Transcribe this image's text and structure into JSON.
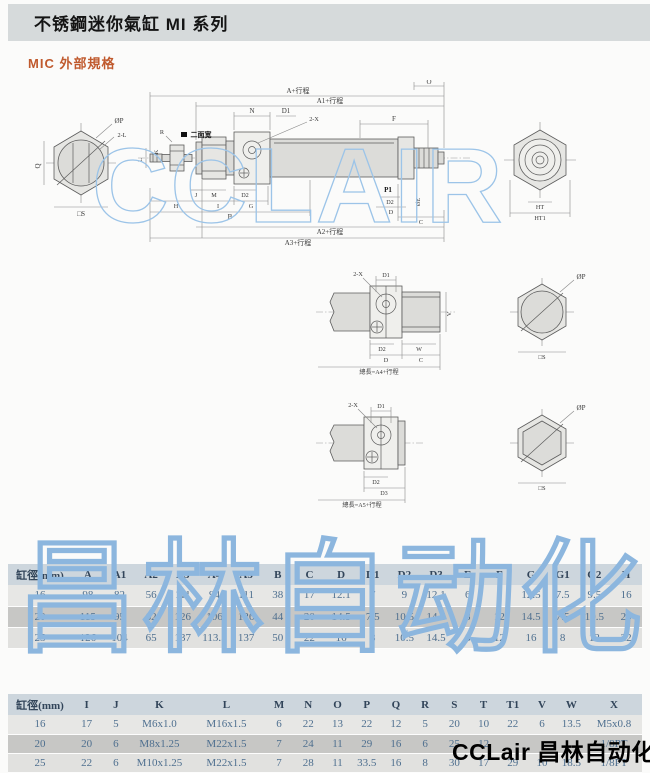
{
  "header": {
    "title": "不锈鋼迷你氣缸 MI 系列"
  },
  "section": {
    "title": "MIC 外部規格"
  },
  "watermarks": {
    "drawing": "CCLAIR",
    "table": "昌林自动化"
  },
  "logo": {
    "text": "CCLair 昌林自动化"
  },
  "colors": {
    "accent_orange": "#c05a2e",
    "watermark_blue": "#8cb6de",
    "table_header_bg": "#cdd6dd",
    "row_dark_bg": "#c7c7c5"
  },
  "dwg": {
    "main": {
      "a_stroke": "A+行程",
      "a1_stroke": "A1+行程",
      "a2_stroke": "A2+行程",
      "a3_stroke": "A3+行程",
      "o": "O",
      "n": "N",
      "d1": "D1",
      "two_x": "2-X",
      "f": "F",
      "r": "R",
      "flats": "二面宽",
      "l": "L",
      "k": "K",
      "j": "J",
      "m": "M",
      "d2": "D2",
      "h": "H",
      "i": "I",
      "g": "G",
      "b": "B",
      "p1": "P1",
      "d2b": "D2",
      "d": "D",
      "oe": "ØE",
      "c": "C",
      "ht": "HT",
      "ht1": "HT1",
      "op": "ØP",
      "two_l": "2-L",
      "q": "Q",
      "s": "□S"
    },
    "view2": {
      "two_x": "2-X",
      "d1": "D1",
      "d2": "D2",
      "w": "W",
      "d": "D",
      "c": "C",
      "v": "V",
      "total": "總長=A4+行程",
      "op": "ØP",
      "s": "□S"
    },
    "view3": {
      "two_x": "2-X",
      "d1": "D1",
      "d2": "D2",
      "d3": "D3",
      "total": "總長=A5+行程",
      "op": "ØP",
      "s": "□S"
    }
  },
  "tables": {
    "dimensions1": {
      "headers": [
        "缸徑(mm)",
        "A",
        "A1",
        "A2",
        "A3",
        "A4",
        "A5",
        "B",
        "C",
        "D",
        "D1",
        "D2",
        "D3",
        "E",
        "F",
        "G",
        "G1",
        "G2",
        "H"
      ],
      "rows": [
        [
          "16",
          "98",
          "82",
          "56",
          "111",
          "94",
          "111",
          "38",
          "17",
          "12.1",
          "7",
          "9",
          "12.1",
          "6",
          "9",
          "12.5",
          "7.5",
          "9.5",
          "16"
        ],
        [
          "20",
          "115",
          "95",
          "62",
          "126",
          "106",
          "126",
          "44",
          "20",
          "14.5",
          "7.5",
          "10.5",
          "14.5",
          "8",
          "12",
          "14.5",
          "7.5",
          "10.5",
          "20"
        ],
        [
          "25",
          "126",
          "104",
          "65",
          "137",
          "113.5",
          "137",
          "50",
          "22",
          "16",
          "8",
          "10.5",
          "14.5",
          "8",
          "12",
          "16",
          "8",
          "12",
          "22"
        ]
      ]
    },
    "dimensions2": {
      "headers": [
        "缸徑(mm)",
        "I",
        "J",
        "K",
        "L",
        "M",
        "N",
        "O",
        "P",
        "Q",
        "R",
        "S",
        "T",
        "T1",
        "V",
        "W",
        "X"
      ],
      "rows": [
        [
          "16",
          "17",
          "5",
          "M6x1.0",
          "M16x1.5",
          "6",
          "22",
          "13",
          "22",
          "12",
          "5",
          "20",
          "10",
          "22",
          "6",
          "13.5",
          "M5x0.8"
        ],
        [
          "20",
          "20",
          "6",
          "M8x1.25",
          "M22x1.5",
          "7",
          "24",
          "11",
          "29",
          "16",
          "6",
          "25",
          "12",
          "",
          "",
          "",
          "1/8PT"
        ],
        [
          "25",
          "22",
          "6",
          "M10x1.25",
          "M22x1.5",
          "7",
          "28",
          "11",
          "33.5",
          "16",
          "8",
          "30",
          "17",
          "29",
          "10",
          "18.5",
          "1/8PT"
        ]
      ]
    }
  }
}
